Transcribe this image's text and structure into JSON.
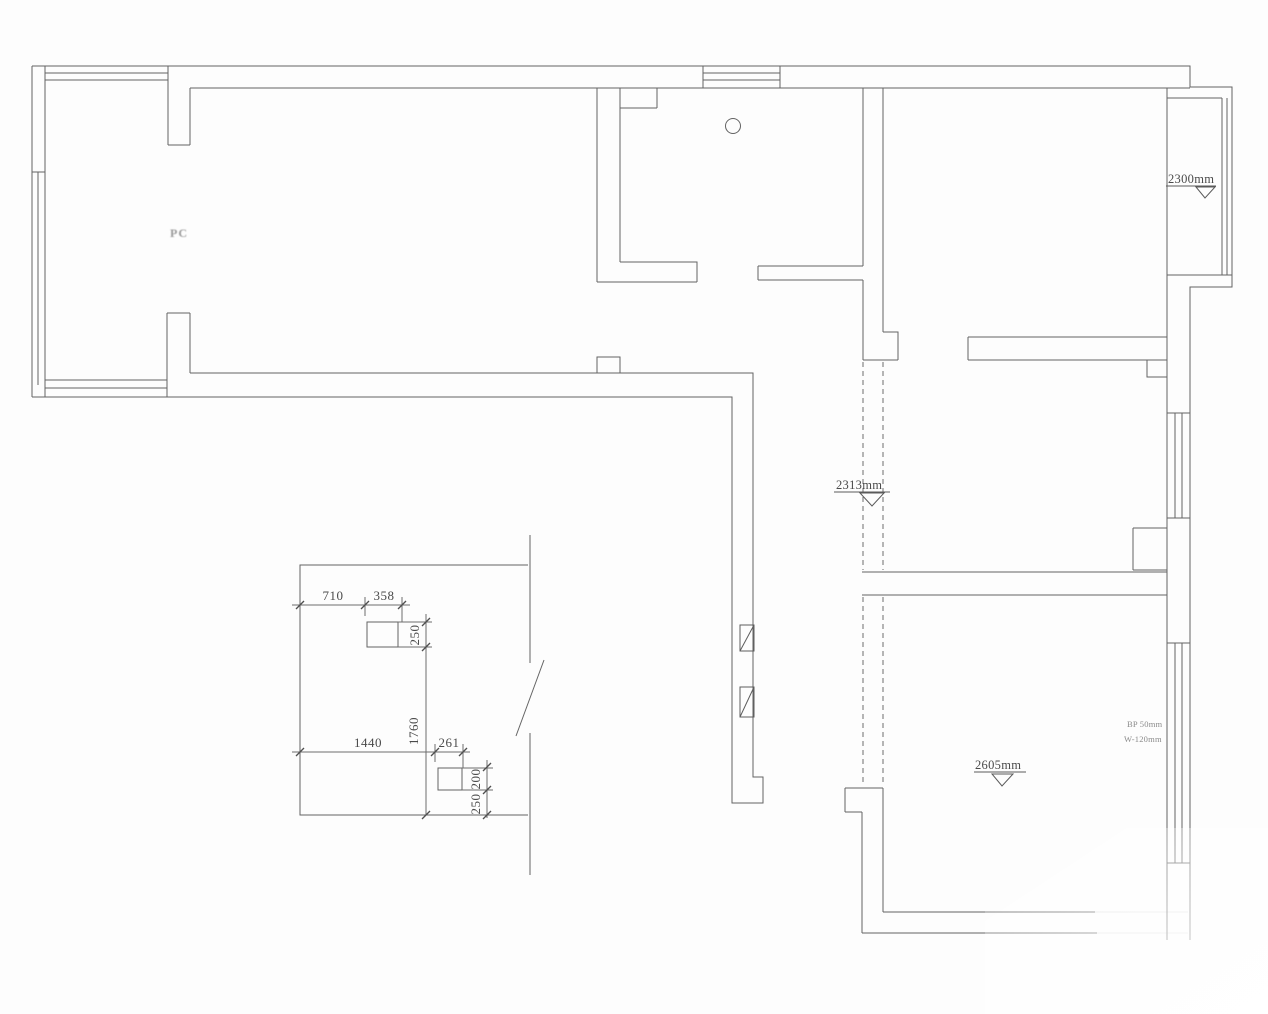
{
  "drawing": {
    "type": "floor-plan-cad",
    "room_label": "PC",
    "elevations": [
      {
        "id": "right-balcony-ceiling",
        "label": "2300mm"
      },
      {
        "id": "hall-ceiling",
        "label": "2313mm"
      },
      {
        "id": "bottom-room-ceiling",
        "label": "2605mm"
      }
    ],
    "notes": {
      "line1": "BP 50mm",
      "line2": "W-120mm"
    },
    "detail": {
      "dims": {
        "w710": "710",
        "w358": "358",
        "h250": "250",
        "h1760": "1760",
        "w1440": "1440",
        "w261": "261",
        "h200": "200",
        "h250b": "250"
      }
    },
    "colors": {
      "line": "#646464",
      "line_light": "#9a9a9a",
      "text": "#4a4a4a",
      "background": "#fdfdfd"
    }
  }
}
